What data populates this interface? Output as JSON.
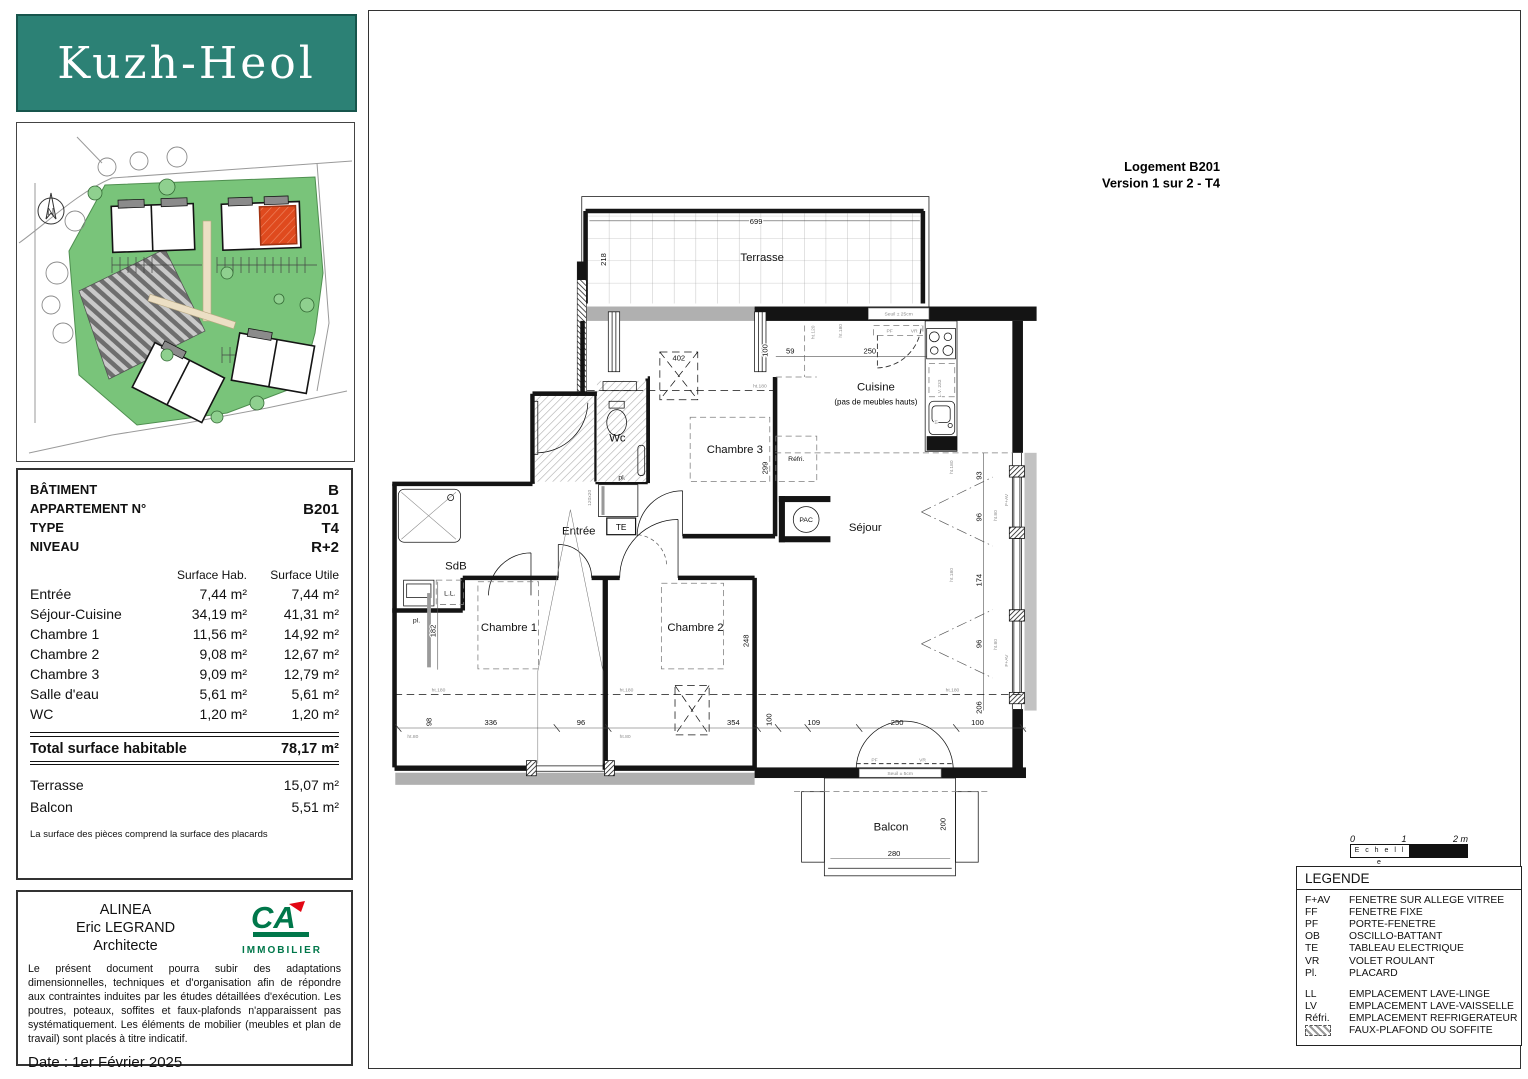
{
  "window": {
    "title1": "Logement B201",
    "title2": "Version 1 sur 2 - T4"
  },
  "logo": {
    "text": "Kuzh-Heol"
  },
  "compass": {
    "n": "N"
  },
  "info": {
    "fields": [
      {
        "label": "BÂTIMENT",
        "value": "B"
      },
      {
        "label": "APPARTEMENT N°",
        "value": "B201"
      },
      {
        "label": "TYPE",
        "value": "T4"
      },
      {
        "label": "NIVEAU",
        "value": "R+2"
      }
    ],
    "col1": "Surface Hab.",
    "col2": "Surface Utile",
    "rooms": [
      {
        "name": "Entrée",
        "hab": "7,44 m²",
        "utile": "7,44 m²"
      },
      {
        "name": "Séjour-Cuisine",
        "hab": "34,19 m²",
        "utile": "41,31 m²"
      },
      {
        "name": "Chambre 1",
        "hab": "11,56 m²",
        "utile": "14,92 m²"
      },
      {
        "name": "Chambre 2",
        "hab": "9,08 m²",
        "utile": "12,67 m²"
      },
      {
        "name": "Chambre 3",
        "hab": "9,09 m²",
        "utile": "12,79 m²"
      },
      {
        "name": "Salle d'eau",
        "hab": "5,61 m²",
        "utile": "5,61 m²"
      },
      {
        "name": "WC",
        "hab": "1,20 m²",
        "utile": "1,20 m²"
      }
    ],
    "total_label": "Total surface habitable",
    "total_value": "78,17 m²",
    "annexes": [
      {
        "name": "Terrasse",
        "value": "15,07 m²"
      },
      {
        "name": "Balcon",
        "value": "5,51 m²"
      }
    ],
    "footnote": "La surface des pièces comprend la surface des placards"
  },
  "architect": {
    "line1": "ALINEA",
    "line2": "Eric LEGRAND",
    "line3": "Architecte",
    "logo_ca": "CA",
    "logo_sub": "IMMOBILIER",
    "disclaimer": "Le présent document pourra subir des adaptations dimensionnelles, techniques et d'organisation afin de répondre aux contraintes induites par les études détaillées d'exécution. Les poutres, poteaux, soffites et faux-plafonds n'apparaissent pas systématiquement. Les éléments de mobilier (meubles et plan de travail) sont placés à titre indicatif.",
    "date": "Date : 1er Février 2025"
  },
  "legend": {
    "title": "LEGENDE",
    "items": [
      {
        "code": "F+AV",
        "label": "FENETRE SUR ALLEGE VITREE"
      },
      {
        "code": "FF",
        "label": "FENETRE FIXE"
      },
      {
        "code": "PF",
        "label": "PORTE-FENETRE"
      },
      {
        "code": "OB",
        "label": "OSCILLO-BATTANT"
      },
      {
        "code": "TE",
        "label": "TABLEAU ELECTRIQUE"
      },
      {
        "code": "VR",
        "label": "VOLET ROULANT"
      },
      {
        "code": "Pl.",
        "label": "PLACARD"
      }
    ],
    "items2": [
      {
        "code": "LL",
        "label": "EMPLACEMENT LAVE-LINGE"
      },
      {
        "code": "LV",
        "label": "EMPLACEMENT LAVE-VAISSELLE"
      },
      {
        "code": "Réfri.",
        "label": "EMPLACEMENT REFRIGERATEUR"
      },
      {
        "code": "",
        "label": "FAUX-PLAFOND OU SOFFITE"
      }
    ]
  },
  "scale": {
    "t0": "0",
    "t1": "1",
    "t2": "2 m",
    "label": "E c h e l l e"
  },
  "plan": {
    "rooms": {
      "terrasse": "Terrasse",
      "cuisine": "Cuisine",
      "cuisine_note": "(pas de meubles hauts)",
      "chambre3": "Chambre 3",
      "chambre1": "Chambre 1",
      "chambre2": "Chambre 2",
      "sejour": "Séjour",
      "entree": "Entrée",
      "sdb": "SdB",
      "wc": "Wc",
      "balcon": "Balcon"
    },
    "ann": {
      "te": "TE",
      "pl": "pl.",
      "ll": "L.L.",
      "lv": "L.V.  233",
      "tri": "tri",
      "refri": "Réfri.",
      "pac": "PAC",
      "seuil25": "Seuil ± 25cm",
      "seuil5": "Seuil ± 5cm",
      "placard_dim": "120x20",
      "pf": "PF",
      "vr": "VR",
      "fav": "F+AV",
      "ht180": "ht.180",
      "ht80": "ht.80",
      "ht120": "ht.120"
    },
    "dims": {
      "t699": "699",
      "t218": "218",
      "soffit402": "402",
      "k100": "100",
      "k59": "59",
      "k250": "250",
      "ch3_299": "299",
      "r93": "93",
      "r96a": "96",
      "r174": "174",
      "r96b": "96",
      "r206": "206",
      "l182": "182",
      "b98": "98",
      "b336": "336",
      "b96": "96",
      "b354": "354",
      "b100a": "100",
      "b109": "109",
      "b250": "250",
      "b100b": "100",
      "ch2_248": "248",
      "bal280": "280",
      "bal200": "200"
    }
  }
}
